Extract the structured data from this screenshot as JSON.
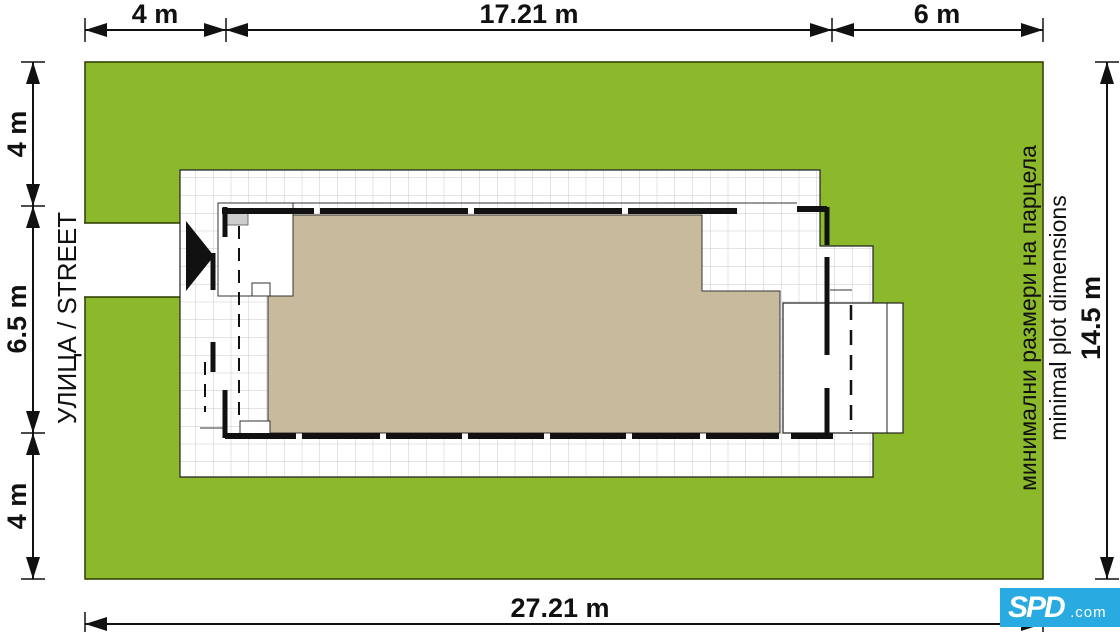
{
  "diagram": {
    "street_label": "УЛИЦА / STREET",
    "note_bg": "минимални размери на парцела",
    "note_en": "minimal plot dimensions"
  },
  "dimensions": {
    "top_segments": [
      "4 m",
      "17.21 m",
      "6 m"
    ],
    "left_segments": [
      "4 m",
      "6.5 m",
      "4 m"
    ],
    "right_total": "14.5 m",
    "bottom_total": "27.21 m"
  },
  "logo": {
    "brand": "SPD",
    "suffix": ".com"
  },
  "colors": {
    "plot_green": "#8CB82C",
    "plot_border": "#2F3A00",
    "roof_beige": "#C8BA9C",
    "paving_line": "#C9C9C9",
    "ink": "#111111",
    "logo_cyan": "#29ABE2"
  }
}
